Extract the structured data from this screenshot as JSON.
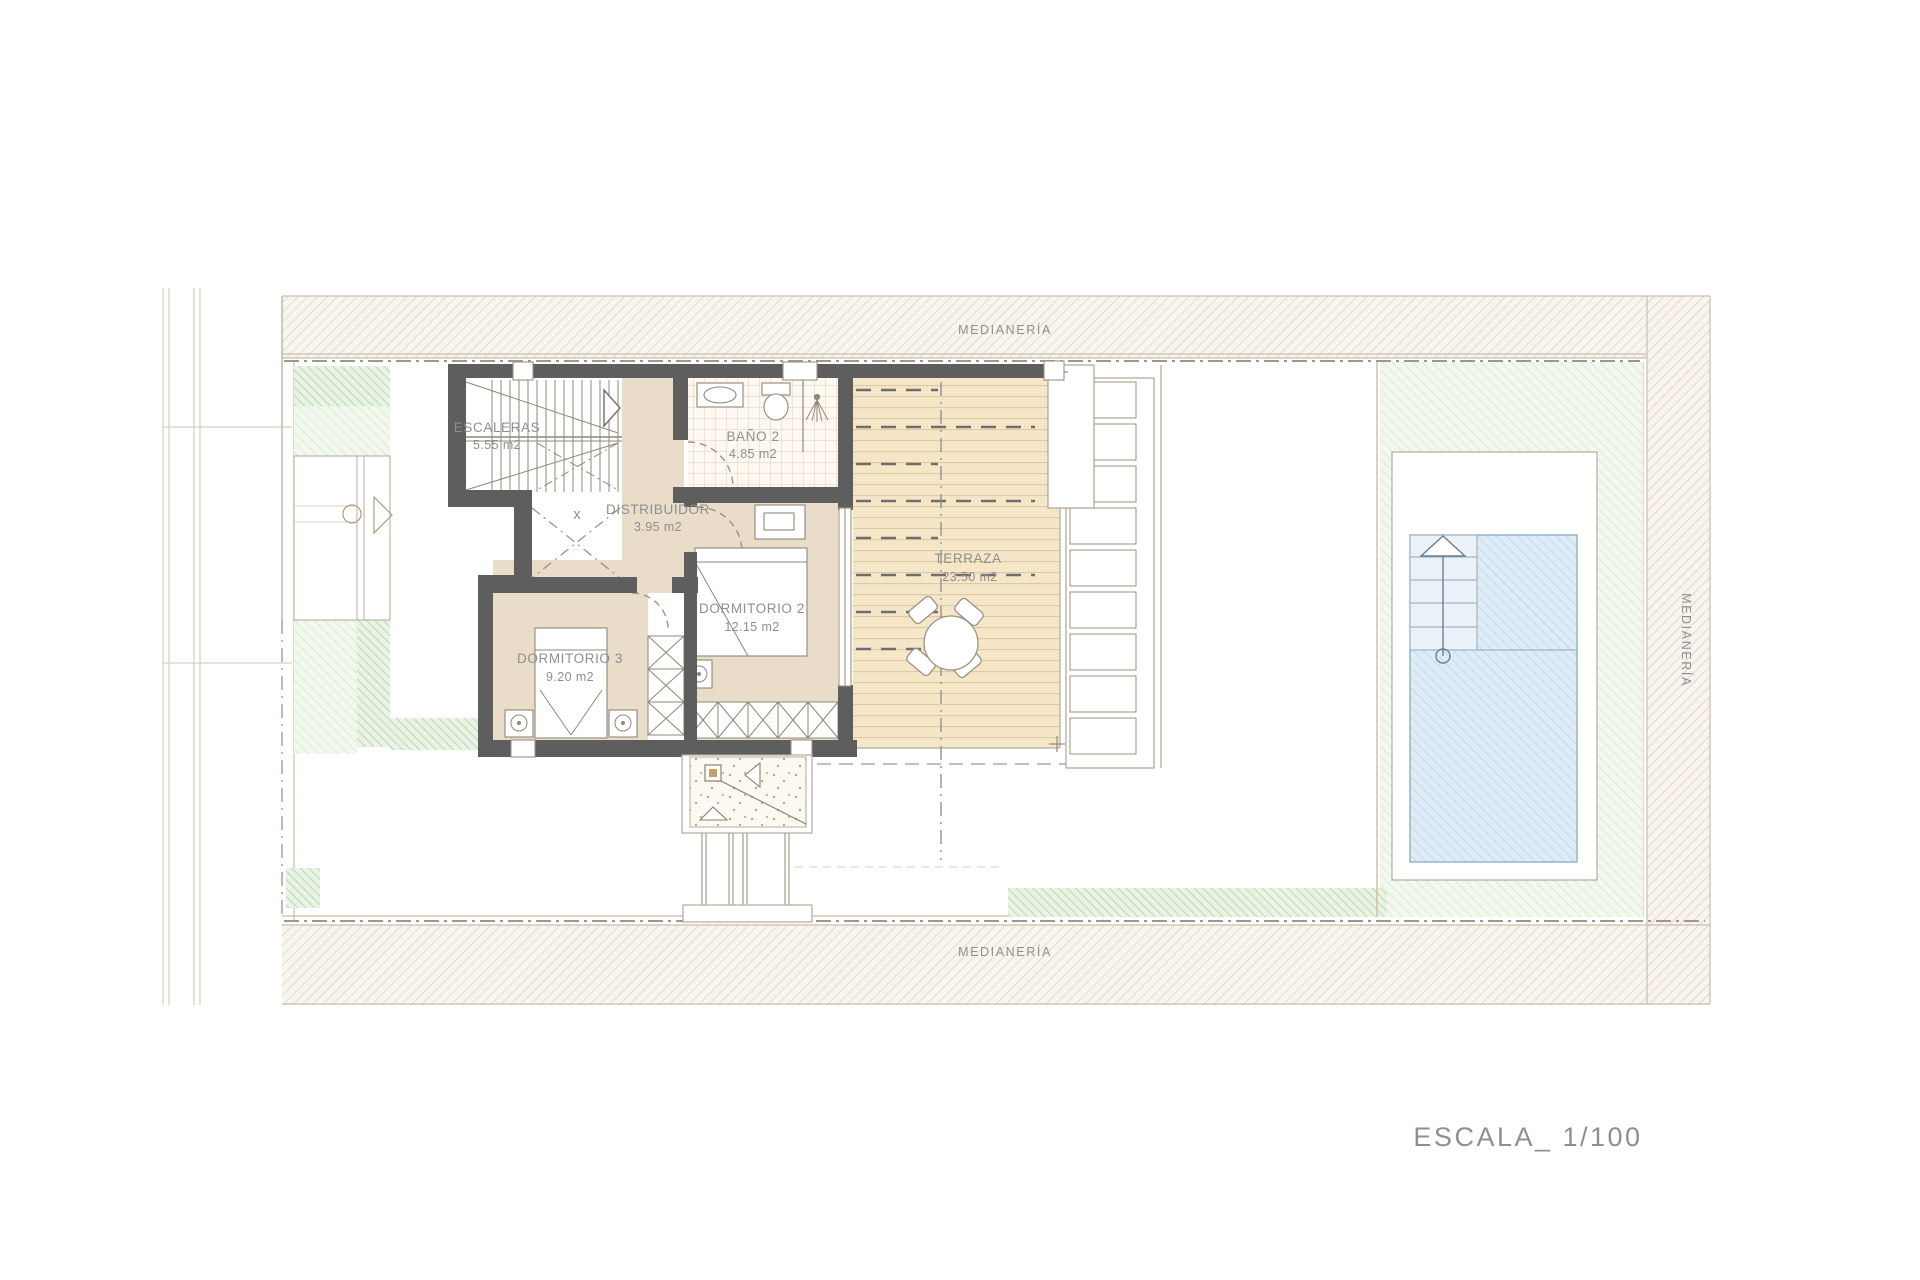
{
  "plan": {
    "boundaries": {
      "top": "MEDIANERÍA",
      "bottom": "MEDIANERÍA",
      "right": "MEDIANERÍA"
    },
    "rooms": [
      {
        "name": "ESCALERAS",
        "area": "5.55 m2"
      },
      {
        "name": "BAÑO 2",
        "area": "4.85 m2"
      },
      {
        "name": "DISTRIBUIDOR",
        "area": "3.95 m2"
      },
      {
        "name": "DORMITORIO 2",
        "area": "12.15 m2"
      },
      {
        "name": "DORMITORIO 3",
        "area": "9.20 m2"
      },
      {
        "name": "TERRAZA",
        "area": "23.50 m2"
      }
    ],
    "void_marker": "x",
    "scale_label": "ESCALA_ 1/100",
    "colors": {
      "wall": "#5e5e5e",
      "floor": "#e9dcc8",
      "deck": "#f5e6c8",
      "deck-line": "#ddc9a3",
      "tile-line": "#e5cdb2",
      "band-bg": "#f8f5ef",
      "band-line": "#d9cfbd",
      "band-line-warm": "#dbc7b8",
      "green-dark": "#abd4a1",
      "green-dark-bg": "#eaf4e5",
      "green-light": "#cfe6c7",
      "green-light-bg": "#f2f8ee",
      "pool-fill": "#ddecf6",
      "pool-line": "#b5d3e6",
      "pool-border": "#8fa9bd",
      "label": "#8f8f8f",
      "outline": "#b7af9f"
    }
  }
}
